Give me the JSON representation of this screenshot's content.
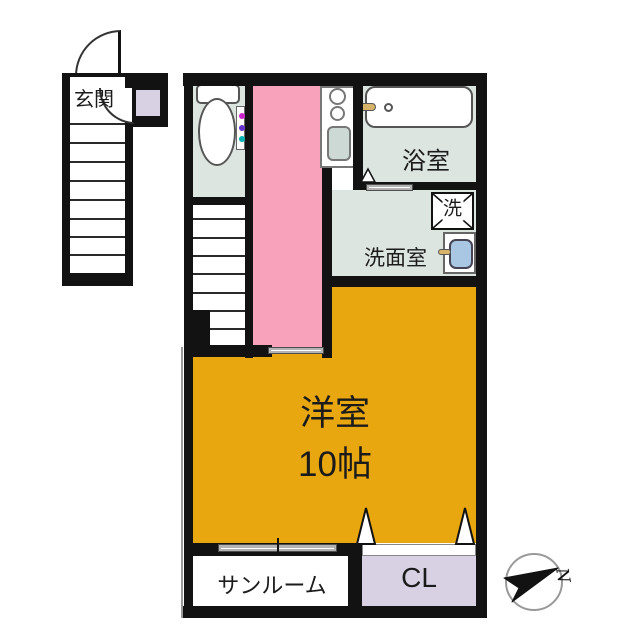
{
  "floorplan": {
    "labels": {
      "entrance": "玄関",
      "bath": "浴室",
      "laundry": "洗",
      "washroom": "洗面室",
      "main_room_name": "洋室",
      "main_room_size": "10帖",
      "sunroom": "サンルーム",
      "closet": "CL",
      "compass_north": "N"
    },
    "colors": {
      "wall": "#121212",
      "corridor": "#f8a3bb",
      "main_room": "#e9a70f",
      "closet": "#d7d1e3",
      "wet_area": "#dde5e1",
      "kitchen_sink": "#ccd9d5",
      "sink_blue": "#a9c6e2",
      "faucet": "#d8b46a",
      "slider": "#b3b3b3"
    }
  }
}
